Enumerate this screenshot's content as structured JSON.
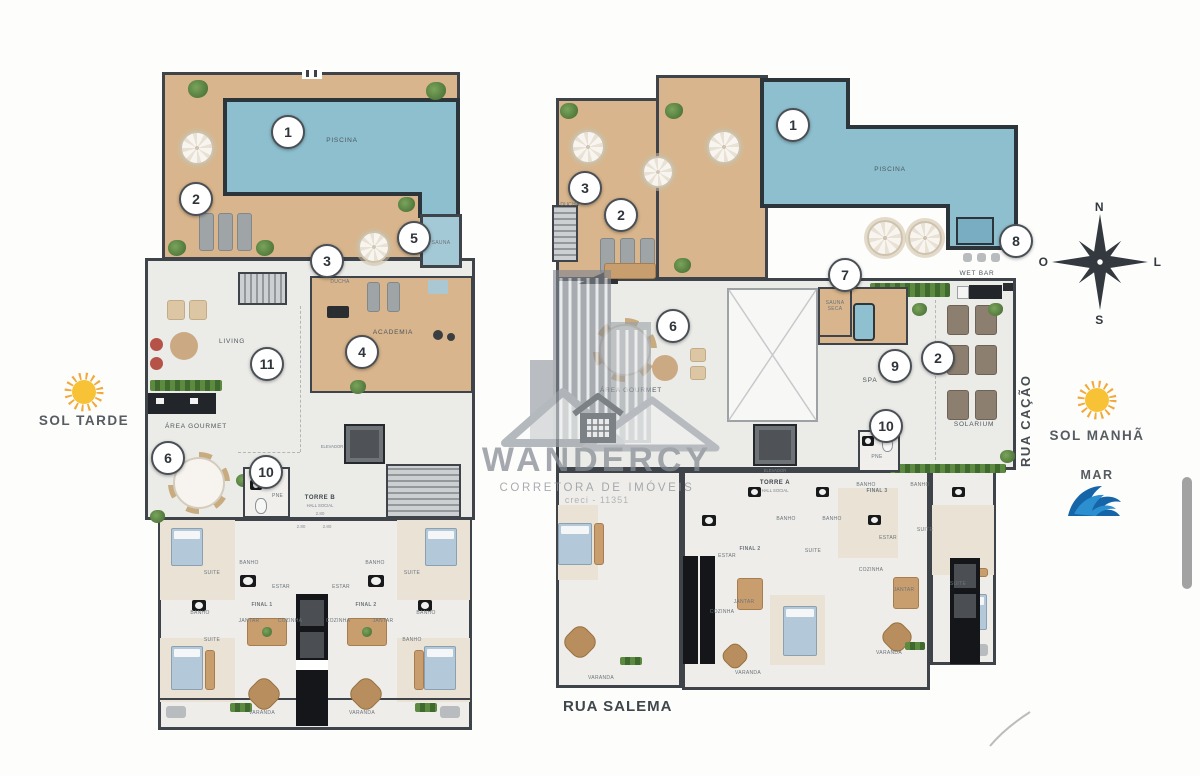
{
  "watermark": {
    "brand": "WANDERCY",
    "tagline": "CORRETORA DE IMÓVEIS",
    "creci": "creci - 11351"
  },
  "compass": {
    "n": "N",
    "s": "S",
    "w": "O",
    "e": "L"
  },
  "sides": {
    "sol_tarde": "SOL TARDE",
    "sol_manha": "SOL MANHÃ",
    "mar": "MAR",
    "rua_cacao": "RUA CAÇÃO",
    "rua_salema": "RUA SALEMA"
  },
  "towers": {
    "b_name": "TORRE B",
    "a_name": "TORRE A",
    "hall": "HALL SOCIAL"
  },
  "rooms": {
    "piscina": "PISCINA",
    "sauna": "SAUNA",
    "sauna_seca": "SAUNA SECA",
    "ducha": "DUCHA",
    "academia": "ACADEMIA",
    "living": "LIVING",
    "area_gourmet": "ÁREA GOURMET",
    "pne": "PNE",
    "elevador": "ELEVADOR",
    "wet_bar": "WET BAR",
    "spa": "SPA",
    "solarium": "SOLARIUM",
    "estar": "ESTAR",
    "jantar": "JANTAR",
    "cozinha": "COZINHA",
    "varanda": "VARANDA",
    "suite": "SUITE",
    "banho": "BANHO",
    "final1": "FINAL 1",
    "final2": "FINAL 2",
    "final3": "FINAL 3"
  },
  "badges": {
    "piscina": "1",
    "deck": "2",
    "ducha": "3",
    "academia": "4",
    "sauna": "5",
    "gourmet": "6",
    "sauna_seca": "7",
    "wet_bar": "8",
    "spa": "9",
    "pne": "10",
    "living": "11",
    "solarium": "2"
  },
  "dims": {
    "w280": "2.80"
  },
  "colors": {
    "pool": "#8dbfce",
    "deck": "#d8b58c",
    "wall": "#3e444a",
    "sun": "#f7c235",
    "wave": "#1f7fc4"
  }
}
